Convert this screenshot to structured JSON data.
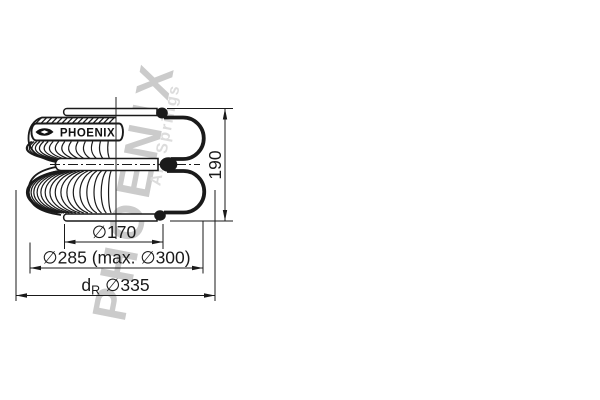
{
  "watermark": {
    "brand": "PHOENIX",
    "tagline": "Air Springs"
  },
  "bellows_label": {
    "brand": "PHOENIX"
  },
  "dimensions": {
    "height": "190",
    "plate_diameter": "∅170",
    "outer_diameter": "∅285 (max. ∅300)",
    "rim_prefix": "d",
    "rim_subscript": "R",
    "rim_diameter": "∅335"
  },
  "colors": {
    "line": "#1a1a1a",
    "background": "#ffffff",
    "watermark": "#cbcbcb",
    "watermark_light": "#dcdcdc"
  }
}
